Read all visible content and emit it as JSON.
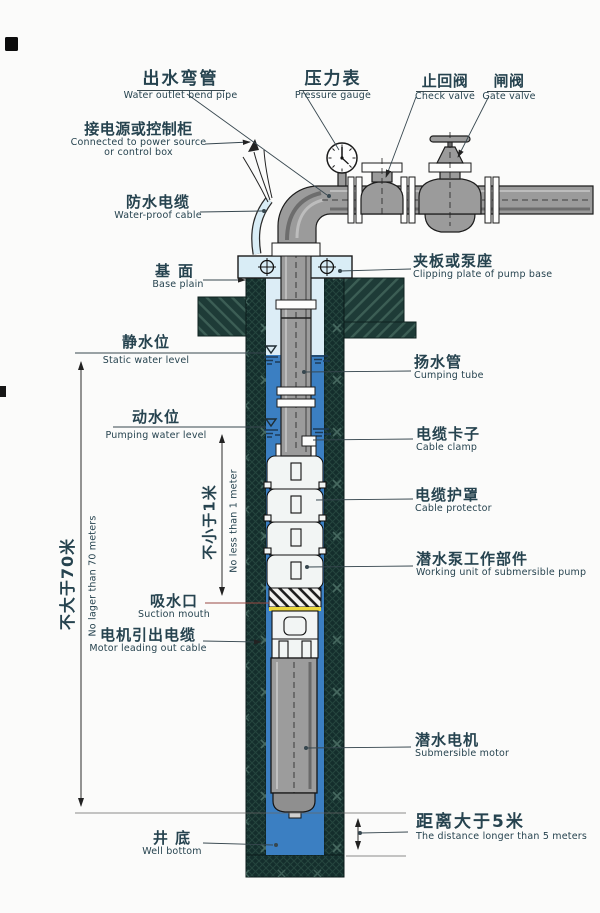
{
  "meta": {
    "width": 600,
    "height": 913,
    "kind": "submersible-pump-installation-diagram"
  },
  "colors": {
    "water": "#3b7fc2",
    "water_pale": "#dcedf6",
    "casing": "#142e2c",
    "foundation": "#1e3b37",
    "pipe_gray": "#9b9b9b",
    "plate_blue": "#d9edf6",
    "accent_yellow": "#ead73c",
    "label": "#26434f"
  },
  "labels": {
    "water_outlet": {
      "zh": "出水弯管",
      "en": "Water outlet bend pipe"
    },
    "pressure_gauge": {
      "zh": "压力表",
      "en": "Pressure gauge"
    },
    "check_valve": {
      "zh": "止回阀",
      "en": "Check valve"
    },
    "gate_valve": {
      "zh": "闸阀",
      "en": "Gate valve"
    },
    "power_source": {
      "zh": "接电源或控制柜",
      "en": "Connected to power source",
      "en2": "or control box"
    },
    "waterproof_cable": {
      "zh": "防水电缆",
      "en": "Water-proof cable"
    },
    "base_plain": {
      "zh": "基面",
      "en": "Base plain"
    },
    "clip_plate": {
      "zh": "夹板或泵座",
      "en": "Clipping plate of pump base"
    },
    "static_level": {
      "zh": "静水位",
      "en": "Static water level"
    },
    "riser": {
      "zh": "扬水管",
      "en": "Cumping tube"
    },
    "pumping_level": {
      "zh": "动水位",
      "en": "Pumping water level"
    },
    "cable_clamp": {
      "zh": "电缆卡子",
      "en": "Cable clamp"
    },
    "cable_protector": {
      "zh": "电缆护罩",
      "en": "Cable protector"
    },
    "working_unit": {
      "zh": "潜水泵工作部件",
      "en": "Working unit of submersible pump"
    },
    "suction": {
      "zh": "吸水口",
      "en": "Suction mouth"
    },
    "motor_cable": {
      "zh": "电机引出电缆",
      "en": "Motor leading out cable"
    },
    "submersible_motor": {
      "zh": "潜水电机",
      "en": "Submersible motor"
    },
    "well_bottom": {
      "zh": "井 底",
      "en": "Well bottom"
    },
    "distance5": {
      "zh": "距离大于5米",
      "en": "The distance longer than 5 meters"
    },
    "dim70": {
      "zh": "不大于70米",
      "en": "No lager than 70 meters"
    },
    "dim1m": {
      "zh": "不小于1米",
      "en": "No less than 1 meter"
    }
  }
}
